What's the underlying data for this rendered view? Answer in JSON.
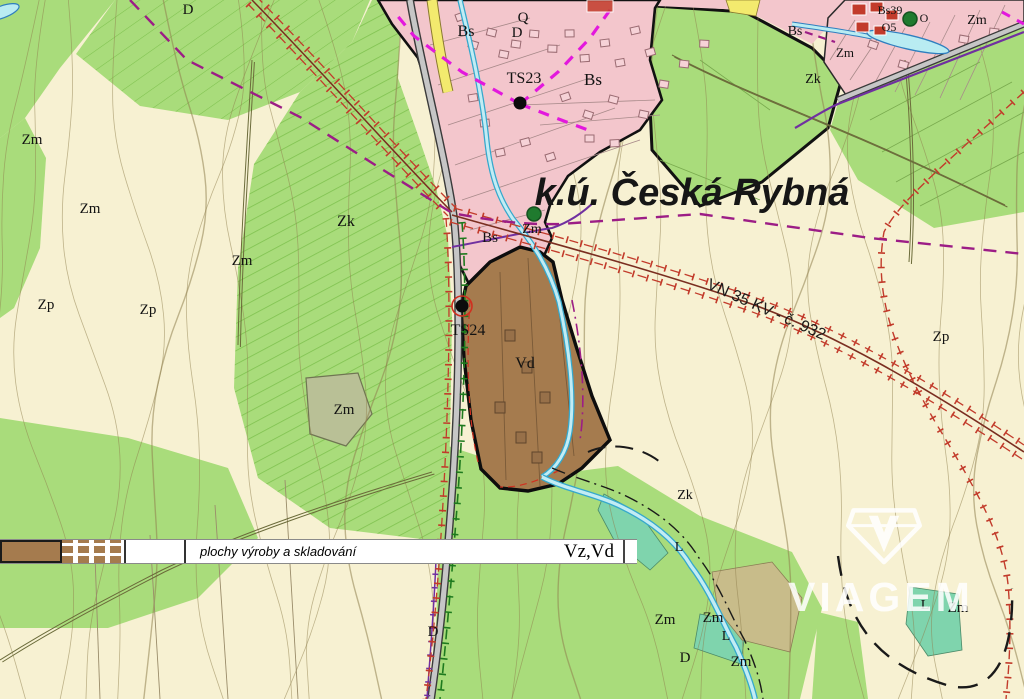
{
  "map": {
    "region_title": "k.ú. Česká Rybná",
    "powerline_label": "VN 35 KV - č. 932",
    "labels": [
      {
        "text": "D",
        "x": 188,
        "y": 14,
        "size": 15
      },
      {
        "text": "Q",
        "x": 523,
        "y": 22,
        "size": 15
      },
      {
        "text": "D",
        "x": 517,
        "y": 37,
        "size": 15
      },
      {
        "text": "Bs",
        "x": 466,
        "y": 36,
        "size": 16
      },
      {
        "text": "TS23",
        "x": 524,
        "y": 83,
        "size": 16
      },
      {
        "text": "Bs",
        "x": 593,
        "y": 85,
        "size": 17
      },
      {
        "text": "Bs39",
        "x": 890,
        "y": 14,
        "size": 12
      },
      {
        "text": "O5",
        "x": 889,
        "y": 31,
        "size": 12
      },
      {
        "text": "O",
        "x": 924,
        "y": 22,
        "size": 12
      },
      {
        "text": "Zm",
        "x": 977,
        "y": 24,
        "size": 14
      },
      {
        "text": "Zm",
        "x": 845,
        "y": 57,
        "size": 13
      },
      {
        "text": "Bs",
        "x": 795,
        "y": 35,
        "size": 14
      },
      {
        "text": "Zk",
        "x": 813,
        "y": 83,
        "size": 14
      },
      {
        "text": "Zm",
        "x": 32,
        "y": 144,
        "size": 15
      },
      {
        "text": "Zm",
        "x": 90,
        "y": 213,
        "size": 15
      },
      {
        "text": "Zm",
        "x": 242,
        "y": 265,
        "size": 15
      },
      {
        "text": "Zp",
        "x": 46,
        "y": 309,
        "size": 15
      },
      {
        "text": "Zp",
        "x": 148,
        "y": 314,
        "size": 15
      },
      {
        "text": "Zk",
        "x": 346,
        "y": 226,
        "size": 16
      },
      {
        "text": "Bs",
        "x": 490,
        "y": 242,
        "size": 15
      },
      {
        "text": "Zm",
        "x": 532,
        "y": 233,
        "size": 14
      },
      {
        "text": "TS24",
        "x": 468,
        "y": 335,
        "size": 16
      },
      {
        "text": "Vd",
        "x": 525,
        "y": 368,
        "size": 16
      },
      {
        "text": "Zp",
        "x": 941,
        "y": 341,
        "size": 15
      },
      {
        "text": "Zk",
        "x": 685,
        "y": 499,
        "size": 14
      },
      {
        "text": "L",
        "x": 679,
        "y": 551,
        "size": 14
      },
      {
        "text": "Zm",
        "x": 344,
        "y": 414,
        "size": 15
      },
      {
        "text": "Zm",
        "x": 665,
        "y": 624,
        "size": 15
      },
      {
        "text": "Zm",
        "x": 713,
        "y": 622,
        "size": 15
      },
      {
        "text": "L",
        "x": 726,
        "y": 640,
        "size": 14
      },
      {
        "text": "D",
        "x": 685,
        "y": 662,
        "size": 15
      },
      {
        "text": "Zm",
        "x": 741,
        "y": 666,
        "size": 15
      },
      {
        "text": "D",
        "x": 433,
        "y": 636,
        "size": 15
      },
      {
        "text": "L",
        "x": 925,
        "y": 609,
        "size": 14
      },
      {
        "text": "Zm",
        "x": 958,
        "y": 612,
        "size": 15
      }
    ]
  },
  "legend": {
    "description": "plochy výroby a skladování",
    "code": "Vz,Vd"
  },
  "watermark": {
    "brand": "VIAGEM"
  },
  "colors": {
    "cream": "#f7f1d2",
    "green": "#a9dc7b",
    "green_dark": "#7fc24f",
    "pink": "#f3c6cc",
    "brown": "#a57b4e",
    "teal": "#7fd4ad",
    "khaki": "#c8bc8a",
    "stream_edge": "#35a8cc",
    "stream_fill": "#c2ecf4",
    "power_red": "#c23b2b",
    "magenta_route": "#e318dd",
    "boundary_magenta": "#9c1d86",
    "road_purple": "#7030a0",
    "rail_green": "#1e7a1e",
    "contour": "#8f7f4e"
  }
}
